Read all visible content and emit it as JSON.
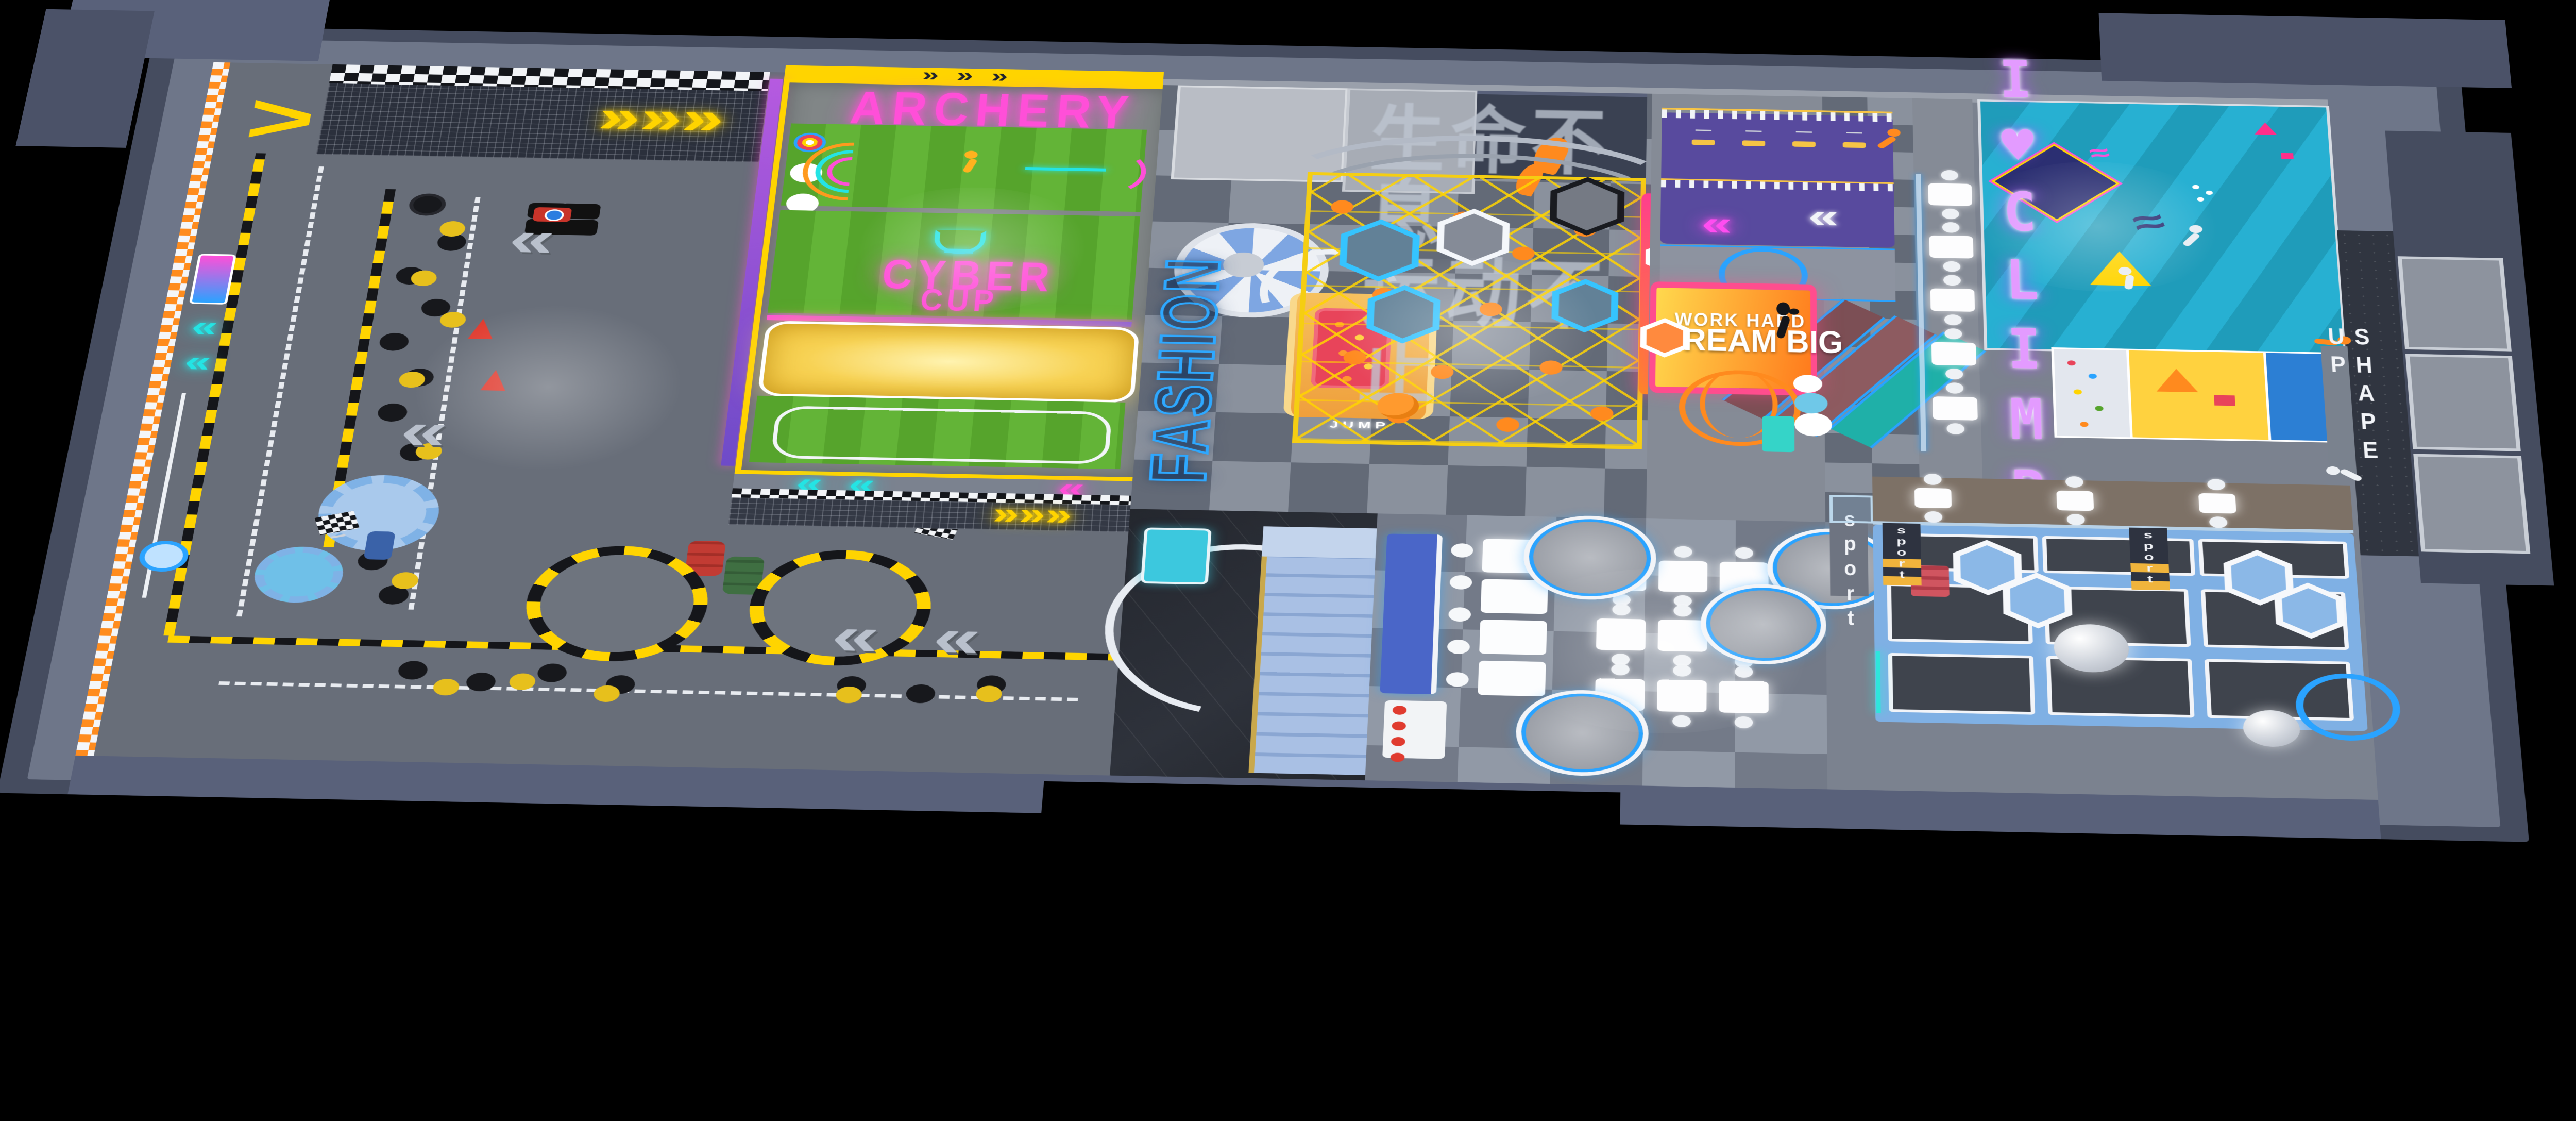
{
  "signs": {
    "archery": "ARCHERY",
    "cyber": "CYBER",
    "cup": "CUP",
    "fashion": "FASHION",
    "work_hard": "WORK HARD",
    "dream_big": "DREAM BIG",
    "adventure_partial": "URE",
    "i_love_climb": "I♥CLIMB",
    "shape_up": "SHAPE UP",
    "sport": "sport",
    "jump_led": "JUMP",
    "wall_slogan_line1": "生命不息",
    "wall_slogan_line2": "运动不止"
  },
  "icons": {
    "chevron_left": "«",
    "chevron_right": "»",
    "chevrons_right_triple": "»»»",
    "chevron_up": ">",
    "squiggle": "≈"
  },
  "colors": {
    "background": "#000000",
    "wall_navy": "#454c5f",
    "wall_light": "#6e7689",
    "floor_gray": "#7b828f",
    "checker_light": "#8a919d",
    "checker_dark": "#636a77",
    "track_gray": "#686e79",
    "curb_yellow": "#ffd400",
    "turf_green": "#56a42c",
    "neon_pink": "#ff4fd8",
    "neon_cyan": "#24e4e4",
    "neon_blue": "#2aa3ff",
    "neon_violet": "#c86bff",
    "orange": "#ff8a1e",
    "slide_orange": "#f2a94e",
    "red": "#e8445a",
    "purple_platform": "#584a9e",
    "teal_wall": "#1f9cba",
    "pad_blue": "#7fb0e4",
    "sign_yellow": "#ffd84d",
    "sign_orange": "#ff7a1c",
    "stair_blue": "#9db8e0",
    "desk_cyan": "#3cc8de"
  }
}
